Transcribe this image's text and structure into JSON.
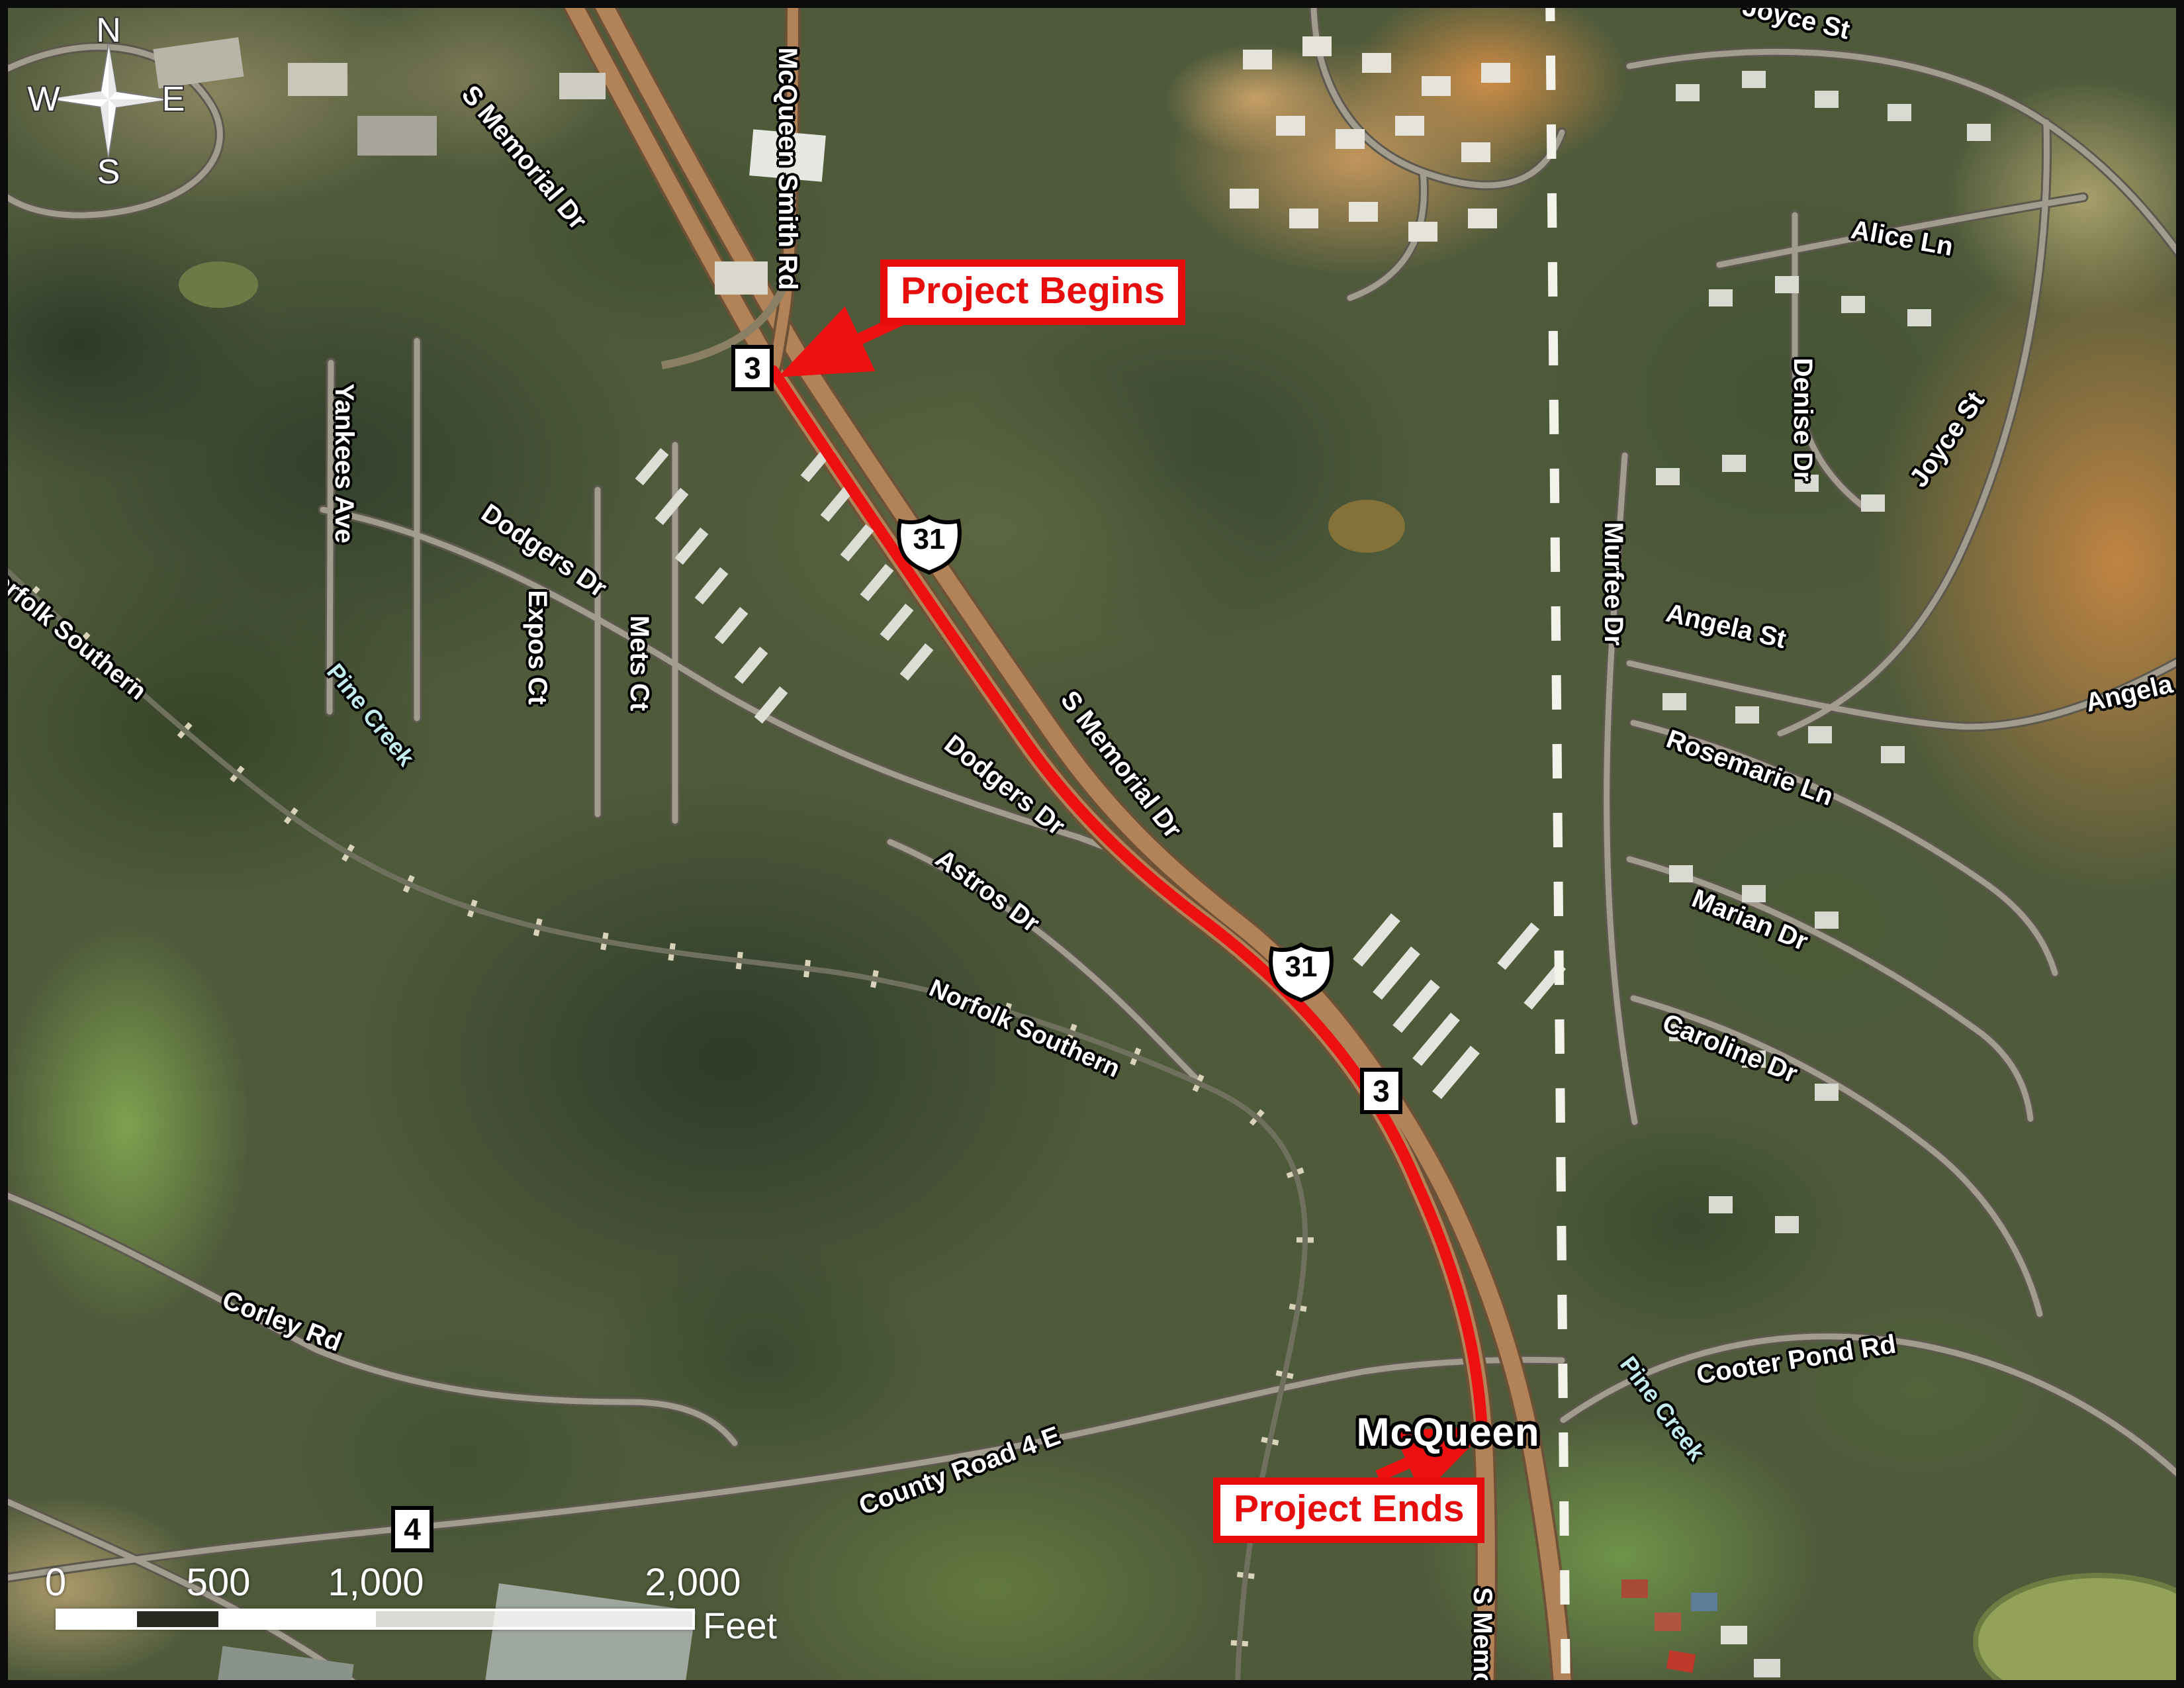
{
  "labels": {
    "s_memorial_top": "S Memorial Dr",
    "s_memorial_mid": "S Memorial Dr",
    "s_memorial_bottom": "S Memorial Dr",
    "mcqueen_smith_rd": "McQueen Smith Rd",
    "yankees_ave": "Yankees Ave",
    "dodgers_dr_upper": "Dodgers Dr",
    "dodgers_dr_lower": "Dodgers Dr",
    "expos_ct": "Expos Ct",
    "mets_ct": "Mets Ct",
    "astros_dr": "Astros Dr",
    "norfolk_southern_west": "Norfolk Southern",
    "norfolk_southern_mid": "Norfolk Southern",
    "pine_creek_west": "Pine Creek",
    "pine_creek_east": "Pine Creek",
    "corley_rd": "Corley Rd",
    "county_road_4e": "County Road 4 E",
    "murfee_dr": "Murfee Dr",
    "joyce_st_top": "Joyce St",
    "joyce_st_east": "Joyce St",
    "alice_ln": "Alice Ln",
    "denise_dr": "Denise Dr",
    "angela_st_west": "Angela St",
    "angela_st_east": "Angela St",
    "rosemarie_ln": "Rosemarie Ln",
    "marian_dr": "Marian Dr",
    "caroline_dr": "Caroline Dr",
    "cooter_pond_rd": "Cooter Pond Rd",
    "mcqueen_place": "McQueen"
  },
  "annotations": {
    "project_begins": "Project Begins",
    "project_ends": "Project Ends"
  },
  "route_shields": {
    "us31": "31",
    "sr3": "3",
    "cr4": "4"
  },
  "compass": {
    "north": "N",
    "south": "S",
    "east": "E",
    "west": "W"
  },
  "scale_bar": {
    "ticks": [
      "0",
      "500",
      "1,000",
      "2,000"
    ],
    "unit_label": "Feet"
  },
  "colors": {
    "project_route": "#ee1010",
    "annotation_red": "#e80d0d",
    "highway_fill": "#b28258",
    "creek_label": "#c3ecee",
    "boundary_dash": "#f2f2ea"
  }
}
